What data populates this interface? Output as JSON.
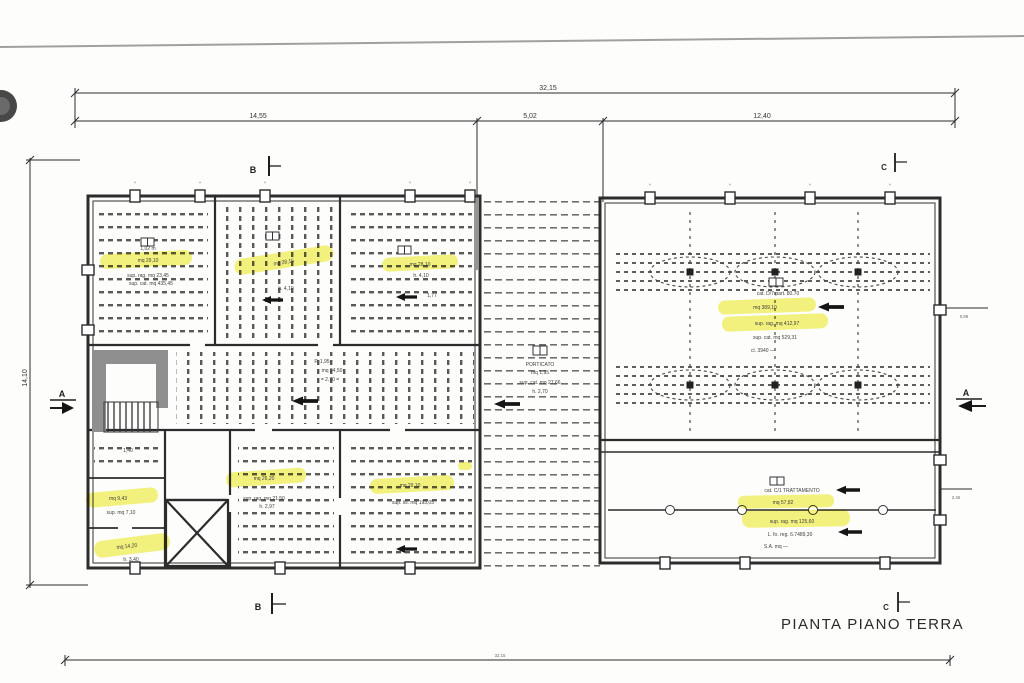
{
  "title": "PIANTA PIANO TERRA",
  "colors": {
    "highlight": "#f1ee4e",
    "ink": "#2c2c2c",
    "poche": "#8f8f8f"
  },
  "dimensions": {
    "overall_top": "32,15",
    "top_left": "14,55",
    "top_mid": "5,02",
    "top_right": "12,40",
    "left_height": "14,10",
    "overall_bottom": "32,15",
    "right_upper": "0,98",
    "right_lower": "2,45",
    "tick": "+"
  },
  "sections": {
    "a": "A",
    "b": "B",
    "c": "C"
  },
  "annotations": {
    "room1": {
      "lines": [
        "1,02 m",
        "mq 29,10",
        "sup. rag. mq 23,45",
        "sup. cat. mq 435,45"
      ]
    },
    "room2": {
      "lines": [
        "mq 28,15",
        "h. 4,10"
      ]
    },
    "room3": {
      "lines": [
        "mq 28,10",
        "h. 4,10",
        "1,77"
      ]
    },
    "hall": {
      "lines": [
        "cat. D/7 part. 80.70",
        "mq 389,10",
        "sup. rag. mq 412,97",
        "sup. cat. mq 529,31",
        "cl. 3940 —"
      ]
    },
    "portico": {
      "lines": [
        "PORTICATO",
        "mq 1,95",
        "sup. cat. mq 27,66",
        "h. 2,70"
      ]
    },
    "corridor": {
      "lines": [
        "P. 1,95",
        "mq 24,50",
        "= 2,70 ="
      ]
    },
    "room4": {
      "lines": [
        "mq 26,20",
        "sup. rag. mq 21,50",
        "h. 2,97"
      ]
    },
    "room5": {
      "lines": [
        "mq 29,10",
        "sup. lis. mq 193,05"
      ]
    },
    "room6": {
      "lines": [
        "1,40",
        "mq 9,43",
        "sup. mq 7,10"
      ]
    },
    "room7": {
      "lines": [
        "mq 14,20",
        "h. 3,40"
      ]
    },
    "lab": {
      "lines": [
        "cat. C/1 TRATTAMENTO",
        "mq 57,82",
        "sup. rag. mq 125,60",
        "L. fo. reg. 6.7489,30",
        "S.A. mq —"
      ]
    }
  }
}
